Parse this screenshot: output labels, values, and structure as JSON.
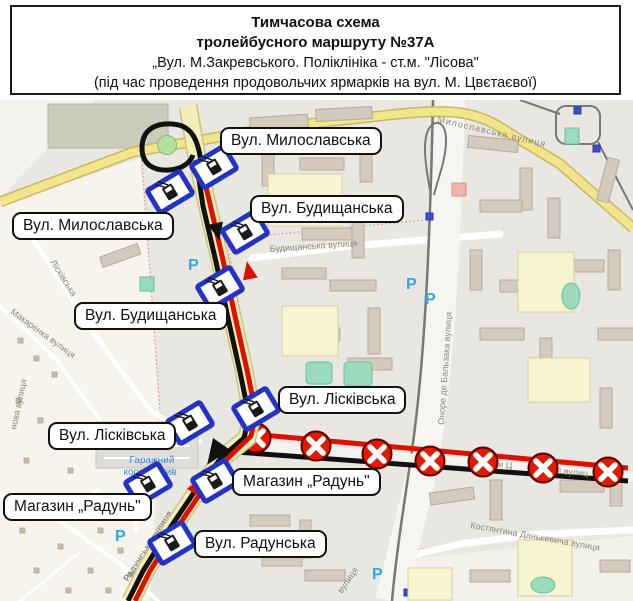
{
  "header": {
    "line1": "Тимчасова схема",
    "line2": "тролейбусного маршруту №37А",
    "line3": "„Вул. М.Закревського. Поліклініка - ст.м. \"Лісова\"",
    "line4": "(під час проведення продовольчих ярмарків на вул. М. Цвєтаєвої)"
  },
  "map": {
    "labels": [
      {
        "text": "Вул. Милославська"
      },
      {
        "text": "Вул. Будищанська"
      },
      {
        "text": "Вул. Милославська"
      },
      {
        "text": "Вул. Будищанська"
      },
      {
        "text": "Вул. Лісківська"
      },
      {
        "text": "Вул. Лісківська"
      },
      {
        "text": "Магазин „Радунь\""
      },
      {
        "text": "Магазин „Радунь\""
      },
      {
        "text": "Вул. Радунська"
      }
    ],
    "streets": [
      {
        "name": "Милославська вулиця"
      },
      {
        "name": "Будищанська вулиця"
      },
      {
        "name": "Лісківська"
      },
      {
        "name": "Макаренка вулиця"
      },
      {
        "name": "Оноре де Бальзака вулиця"
      },
      {
        "name": "Радунська вулиця"
      },
      {
        "name": "Костянтина Данькевича вулиця"
      },
      {
        "name": "рини Ц"
      },
      {
        "name": "вої вулиц"
      },
      {
        "name": "вулиця"
      },
      {
        "name": "нова вулиця"
      }
    ],
    "poi": {
      "garage_line1": "Гаражний",
      "garage_line2": "кооператив"
    },
    "parking_symbol": "P",
    "trolleybus_stop_count": 9,
    "closed_stop_count": 7,
    "colors": {
      "route_outbound_black": "#111111",
      "route_return_red": "#dd1100",
      "closed_marker_red": "#e11a00",
      "stop_frame_blue": "#2433c4",
      "main_road_yellow": "#f2e68c",
      "parking_blue": "#35a7e0"
    }
  }
}
